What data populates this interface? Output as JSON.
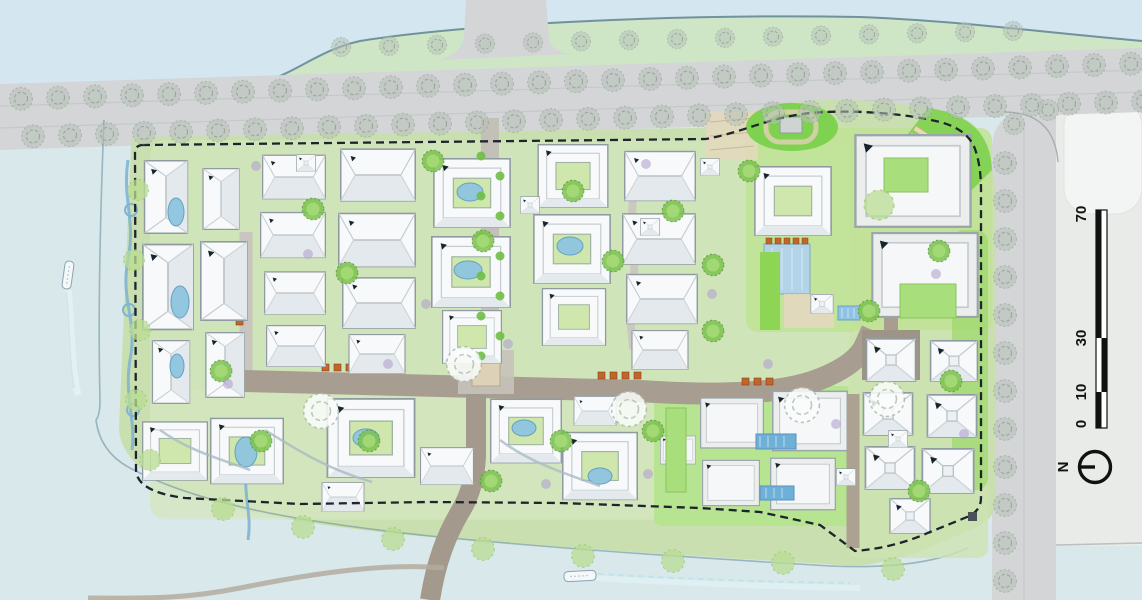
{
  "drawing": {
    "kind": "architectural masterplan site plan",
    "description": "Residential compound site plan surrounded by water and tree-lined roads"
  },
  "scale_bar": {
    "labels": [
      "0",
      "10",
      "30",
      "70"
    ]
  },
  "north_indicator": {
    "label": "N"
  },
  "palette": {
    "water": "#d9e8ea",
    "water_top": "#d4e6ef",
    "road_gray": "#d3d5d6",
    "street_brown": "#a79d90",
    "site_green": "#c9dfb0",
    "lawn_bright": "#8ed455",
    "building_white": "#f7f9fa",
    "roof_shade": "#e3e9ec",
    "building_outline": "#8f9ba1",
    "pond_blue": "#8fc5df",
    "pool_blue": "#6fb0d9",
    "boundary_dash": "#1d242b",
    "planter_orange": "#c0662c",
    "tree_green": "#7cc24e",
    "shrub_purple": "#b3a3d1",
    "terrace_beige": "#e8dab6"
  },
  "icons": {
    "north_arrow": "compass circle with radius line",
    "scale_bar": "alternating black and white bar scale",
    "boat": "small boat with wake",
    "tree": "round canopy tree",
    "street_tree": "sketched street tree",
    "shrub": "purple shrub dot",
    "building_entry_mark": "tiny black entry tick on each building"
  }
}
